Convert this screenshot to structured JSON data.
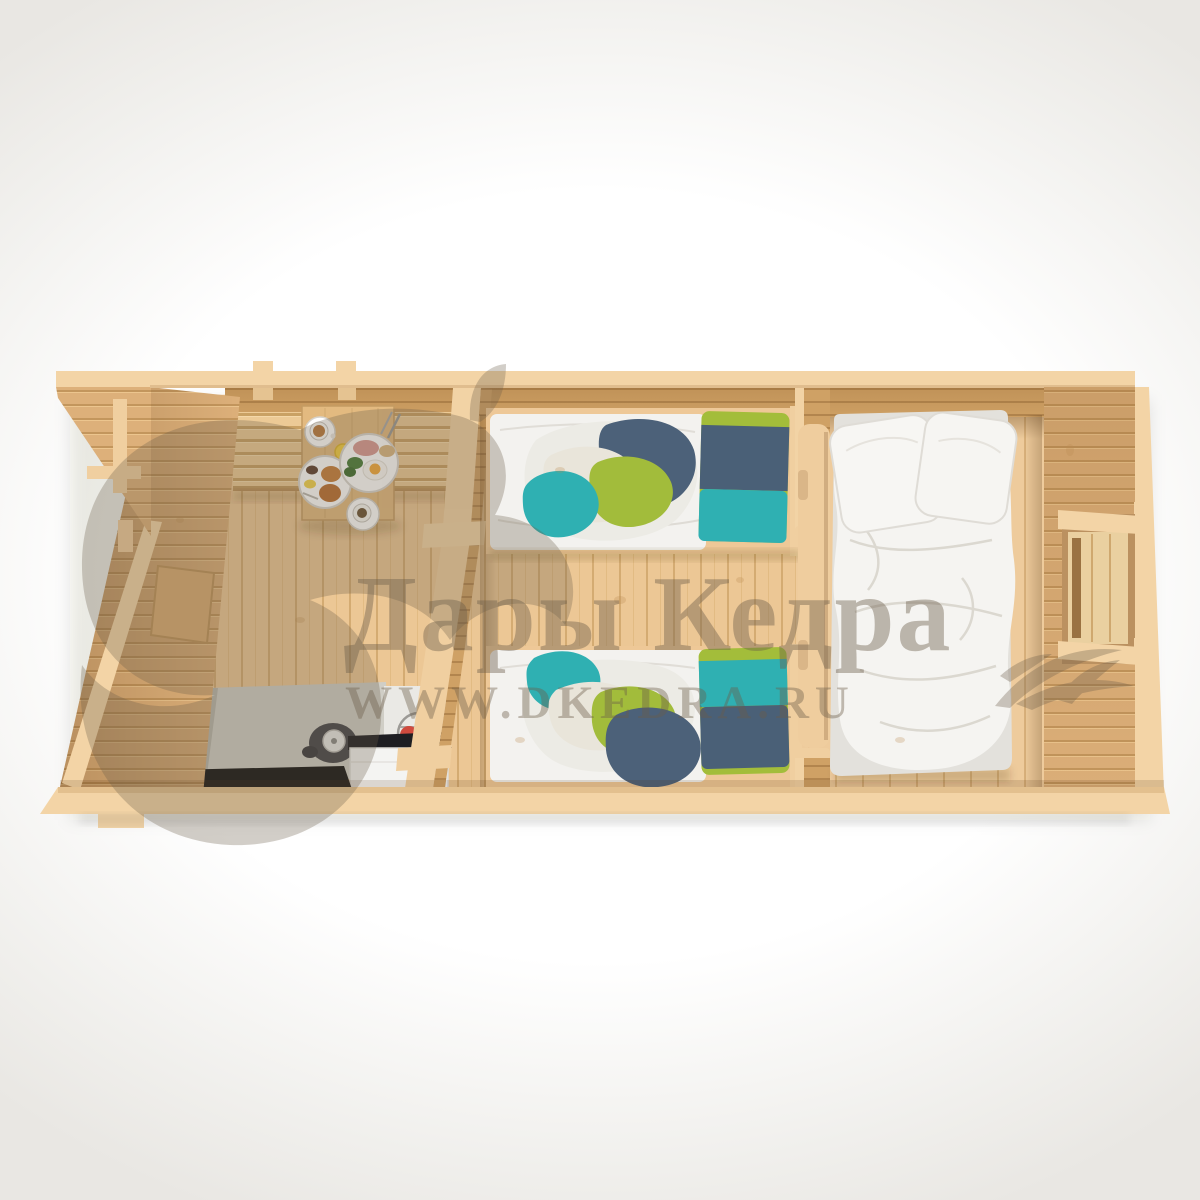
{
  "watermark": {
    "title": "Дары Кедра",
    "url": "WWW.DKEDRA.RU"
  },
  "palette": {
    "background": "#ffffff",
    "cut_edge_beige": "#f3d4a6",
    "wall_wood": "#dcb07a",
    "wall_wood_dark": "#c89c63",
    "floor_wood": "#eac692",
    "bench_wood": "#ecca96",
    "table_wood": "#e3ba80",
    "counter_gray": "#d0cec6",
    "cooktop_black": "#161616",
    "cabinet_white": "#f4f4f2",
    "linen_white": "#f3f2ef",
    "duvet_white": "#f5f4f1",
    "pillow_navy": "#4a6077",
    "pillow_teal": "#2fb0b2",
    "pillow_green": "#a0bb37",
    "watermark_color": "#6b5c49"
  },
  "scene": {
    "view": "top-down cutaway 3D render",
    "structure": "log cabin floor plan",
    "rooms": [
      {
        "name": "kitchen-dining",
        "items": [
          "wall-bench",
          "dining-table",
          "breakfast-dishes",
          "countertop",
          "kettle",
          "induction-cooktop",
          "white-cabinet",
          "fruit-holder"
        ]
      },
      {
        "name": "twin-bedroom",
        "items": [
          "single-bed-top",
          "single-bed-bottom",
          "striped-pillows",
          "blankets"
        ]
      },
      {
        "name": "double-bedroom",
        "items": [
          "double-bed",
          "white-duvet",
          "two-pillows",
          "window"
        ]
      }
    ],
    "exterior": [
      "roof-overhang",
      "porch-bracket",
      "floor-platform",
      "doorways"
    ]
  }
}
